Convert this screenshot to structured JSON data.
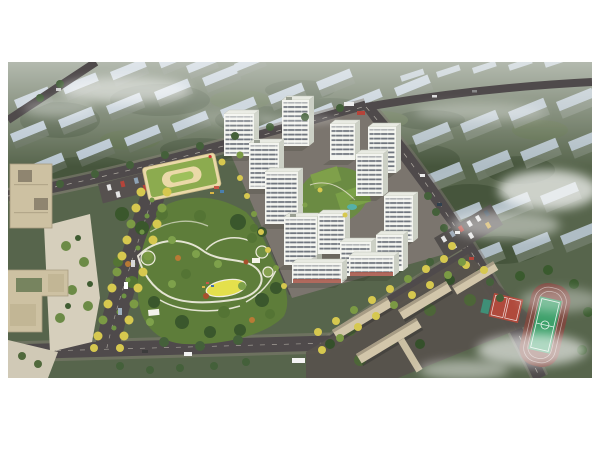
{
  "scene": {
    "description": "Aerial perspective rendering of a modern residential community: white high-rise apartment towers around a landscaped central courtyard, a large public park with looping white paths and a yellow flower meadow, a kindergarten with a green roof and oval courtyard, beige office blocks with a plaza, tree-lined avenues with autumn-yellow trees, a school campus with a running track, football pitch and red basketball courts, and rows of hazy blue-grey apartment blocks fading into fog in the distance.",
    "regions": [
      "hazy distant apartment blocks",
      "perimeter roads with autumn trees",
      "white residential towers",
      "central landscaped courtyard with green roofs",
      "kindergarten with green roof",
      "surface parking lots with cars",
      "office buildings and plaza",
      "central park with winding paths",
      "yellow flower meadow",
      "retail street with red storefronts",
      "school campus slab buildings",
      "running track and football pitch",
      "red basketball courts",
      "fog and cloud wisps"
    ],
    "colors": {
      "white_margin": "#ffffff",
      "terrain_green": "#57654c",
      "distant_roof": "#b7c5d0",
      "distant_wall": "#5f6b58",
      "road_asphalt": "#4f4a4b",
      "sidewalk": "#8a847a",
      "tower_white": "#f3f4ef",
      "tower_side": "#ccd0c5",
      "tower_roof": "#e8eae2",
      "window_band": "#59616b",
      "storefront_red": "#a85a4c",
      "park_green": "#5e7d3a",
      "tree_dark": "#3a572c",
      "tree_mid": "#547434",
      "tree_light": "#7ea14b",
      "autumn_tree": "#d6c84f",
      "accent_orange": "#b97a35",
      "meadow_yellow": "#e4e04c",
      "path_white": "#f0ede0",
      "kindergarten_roof": "#8cab4f",
      "kindergarten_wall": "#ead9a8",
      "office_beige": "#cdc1a2",
      "plaza_paving": "#d6cfbc",
      "school_beige": "#d2c6aa",
      "track_red": "#7d4a40",
      "pitch_green": "#3da06a",
      "court_red": "#b04a3c",
      "pool_teal": "#55b0a8",
      "fog_white": "#ffffff"
    }
  }
}
